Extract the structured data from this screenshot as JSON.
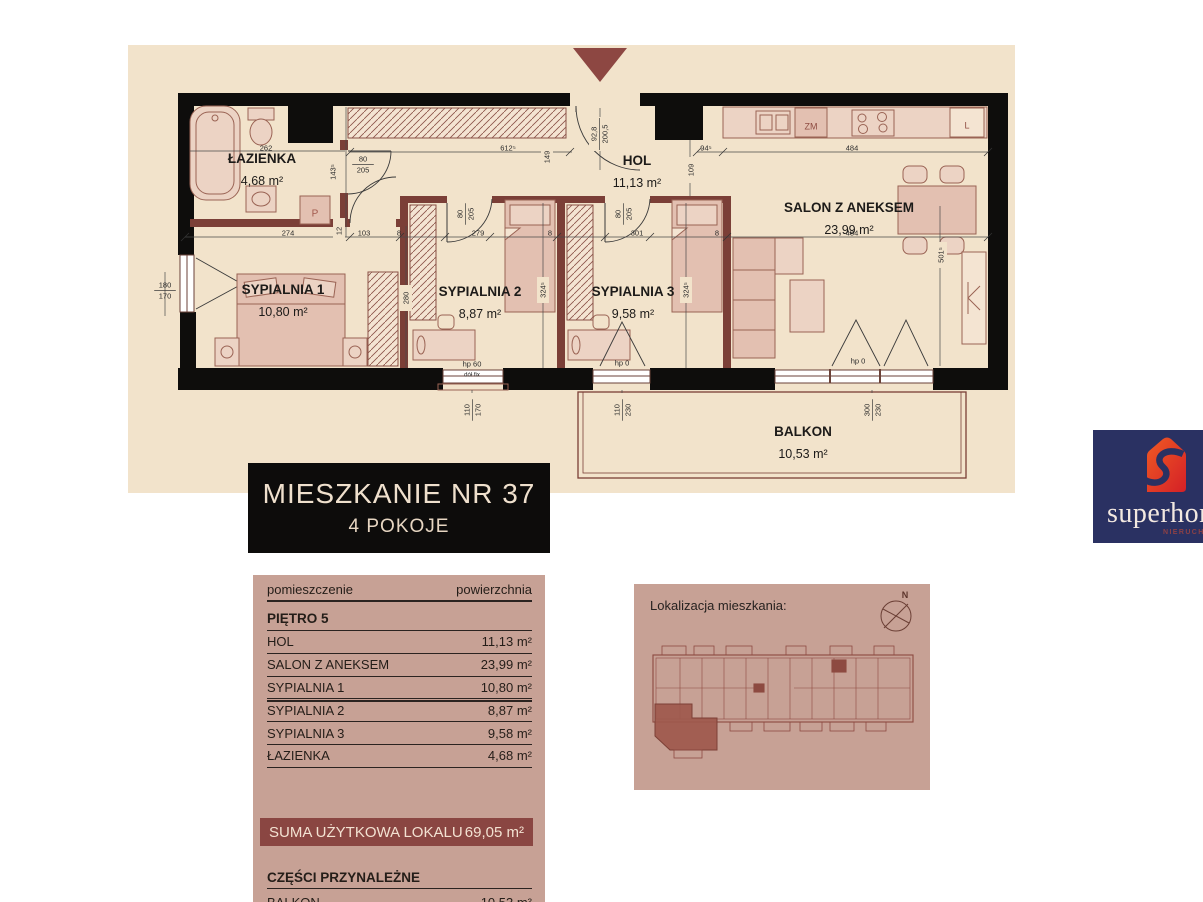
{
  "title_card": {
    "line1": "MIESZKANIE NR 37",
    "line2": "4 POKOJE"
  },
  "area_table": {
    "col_room": "pomieszczenie",
    "col_area": "powierzchnia",
    "floor_label": "PIĘTRO 5",
    "rows": [
      [
        "HOL",
        "11,13 m²"
      ],
      [
        "SALON Z ANEKSEM",
        "23,99 m²"
      ],
      [
        "SYPIALNIA 1",
        "10,80 m²"
      ],
      [
        "SYPIALNIA 2",
        "8,87 m²"
      ],
      [
        "SYPIALNIA 3",
        "9,58 m²"
      ],
      [
        "ŁAZIENKA",
        "4,68 m²"
      ]
    ],
    "sum_label": "SUMA UŻYTKOWA LOKALU",
    "sum_value": "69,05 m²",
    "annex_label": "CZĘŚCI PRZYNALEŻNE",
    "annex_rows": [
      [
        "BALKON",
        "10,53 m²"
      ]
    ]
  },
  "location": {
    "label": "Lokalizacja mieszkania:",
    "compass": "N"
  },
  "logo": {
    "brand": "superhome",
    "sub": "NIERUCHOMOŚCI"
  },
  "plan": {
    "rooms": [
      {
        "name": "ŁAZIENKA",
        "area": "4,68 m²",
        "x": 262,
        "y": 163
      },
      {
        "name": "HOL",
        "area": "11,13 m²",
        "x": 637,
        "y": 165
      },
      {
        "name": "SALON Z ANEKSEM",
        "area": "23,99 m²",
        "x": 849,
        "y": 212
      },
      {
        "name": "SYPIALNIA 1",
        "area": "10,80 m²",
        "x": 283,
        "y": 294
      },
      {
        "name": "SYPIALNIA 2",
        "area": "8,87 m²",
        "x": 480,
        "y": 296
      },
      {
        "name": "SYPIALNIA 3",
        "area": "9,58 m²",
        "x": 633,
        "y": 296
      },
      {
        "name": "BALKON",
        "area": "10,53 m²",
        "x": 803,
        "y": 436
      }
    ],
    "dims": [
      {
        "t": "262",
        "x": 266,
        "y": 148
      },
      {
        "t": "612⁵",
        "x": 508,
        "y": 148
      },
      {
        "t": "149",
        "x": 547,
        "y": 157,
        "r": -90
      },
      {
        "t": "80/205",
        "x": 363,
        "y": 164,
        "f": 1
      },
      {
        "t": "143⁵",
        "x": 333,
        "y": 172,
        "r": -90
      },
      {
        "t": "92,8/200,5",
        "x": 599,
        "y": 134,
        "r": -90,
        "f": 1
      },
      {
        "t": "94⁵",
        "x": 706,
        "y": 148
      },
      {
        "t": "484",
        "x": 852,
        "y": 148
      },
      {
        "t": "109",
        "x": 691,
        "y": 170,
        "r": -90
      },
      {
        "t": "80/205",
        "x": 465,
        "y": 214,
        "r": -90,
        "f": 1
      },
      {
        "t": "80/205",
        "x": 623,
        "y": 214,
        "r": -90,
        "f": 1
      },
      {
        "t": "274",
        "x": 288,
        "y": 233
      },
      {
        "t": "12",
        "x": 339,
        "y": 231,
        "r": -90
      },
      {
        "t": "103",
        "x": 364,
        "y": 233
      },
      {
        "t": "8",
        "x": 399,
        "y": 233
      },
      {
        "t": "279",
        "x": 478,
        "y": 233
      },
      {
        "t": "8",
        "x": 550,
        "y": 233
      },
      {
        "t": "301",
        "x": 637,
        "y": 233
      },
      {
        "t": "8",
        "x": 717,
        "y": 233
      },
      {
        "t": "484",
        "x": 852,
        "y": 233
      },
      {
        "t": "280",
        "x": 406,
        "y": 298,
        "r": -90
      },
      {
        "t": "324⁵",
        "x": 543,
        "y": 290,
        "r": -90
      },
      {
        "t": "324⁵",
        "x": 686,
        "y": 290,
        "r": -90
      },
      {
        "t": "501⁵",
        "x": 941,
        "y": 255,
        "r": -90
      },
      {
        "t": "180/170",
        "x": 165,
        "y": 290,
        "f": 1
      },
      {
        "t": "hp 60",
        "x": 472,
        "y": 364
      },
      {
        "t": "dół fix",
        "x": 472,
        "y": 374,
        "s": 6
      },
      {
        "t": "110/170",
        "x": 472,
        "y": 410,
        "r": -90,
        "f": 1
      },
      {
        "t": "hp 0",
        "x": 622,
        "y": 363
      },
      {
        "t": "110/230",
        "x": 622,
        "y": 410,
        "r": -90,
        "f": 1
      },
      {
        "t": "hp 0",
        "x": 858,
        "y": 361
      },
      {
        "t": "300/230",
        "x": 872,
        "y": 410,
        "r": -90,
        "f": 1
      },
      {
        "t": "P",
        "x": 315,
        "y": 214,
        "s": 10,
        "c": "#a1574b"
      },
      {
        "t": "ZM",
        "x": 811,
        "y": 127,
        "s": 9,
        "c": "#8f4c42"
      },
      {
        "t": "L",
        "x": 967,
        "y": 126,
        "s": 9,
        "c": "#8f4c42"
      }
    ]
  },
  "colors": {
    "plan_bg": "#f2e3cb",
    "panel_pink": "#c7a195",
    "sum_bar": "#8a4642",
    "wall_black": "#0e0d0c",
    "wall_maroon": "#7b3f37",
    "logo_navy": "#2a3162",
    "logo_orange": "#e94e1b"
  }
}
